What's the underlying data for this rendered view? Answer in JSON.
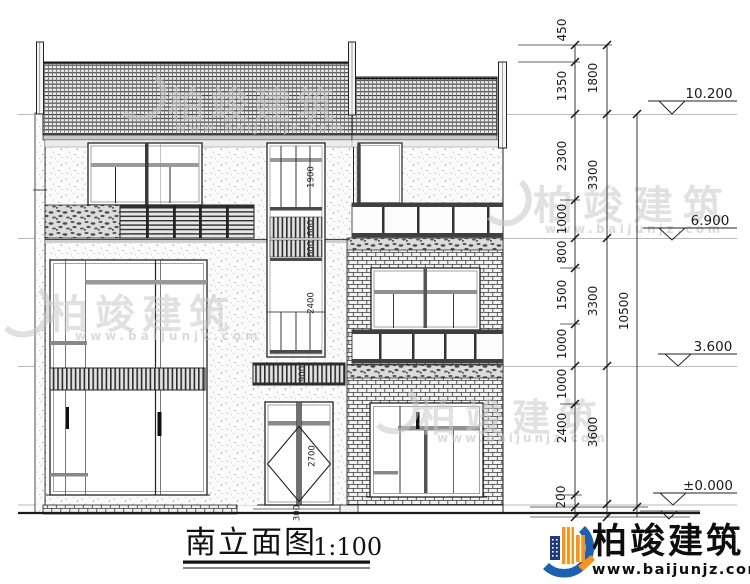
{
  "title": {
    "name": "南立面图",
    "scale": "1:100"
  },
  "levels": {
    "roof": "10.200",
    "third": "6.900",
    "second": "3.600",
    "ground": "±0.000"
  },
  "dims": {
    "chain1": [
      "450",
      "1350",
      "2300",
      "1000",
      "800",
      "1500",
      "1000",
      "1000",
      "2400",
      "200"
    ],
    "chain2": [
      "1800",
      "3300",
      "3300",
      "3600"
    ],
    "chain3": [
      "10500"
    ]
  },
  "annotations": {
    "stair_window": "1900",
    "stair_louver_a": "600",
    "stair_louver_b": "600",
    "stair_glass": "2400",
    "canopy_band": "900",
    "entry_door": "2700",
    "door_step": "300"
  },
  "watermark": {
    "brand": "柏竣建筑",
    "site": "www.baijunjz.com"
  },
  "logo": {
    "brand": "柏竣建筑",
    "site": "www.baijunjz.com"
  },
  "colors": {
    "logo_blue": "#1d5fb0",
    "logo_orange": "#f7941d",
    "logo_navy": "#203a77",
    "line": "#222222"
  }
}
